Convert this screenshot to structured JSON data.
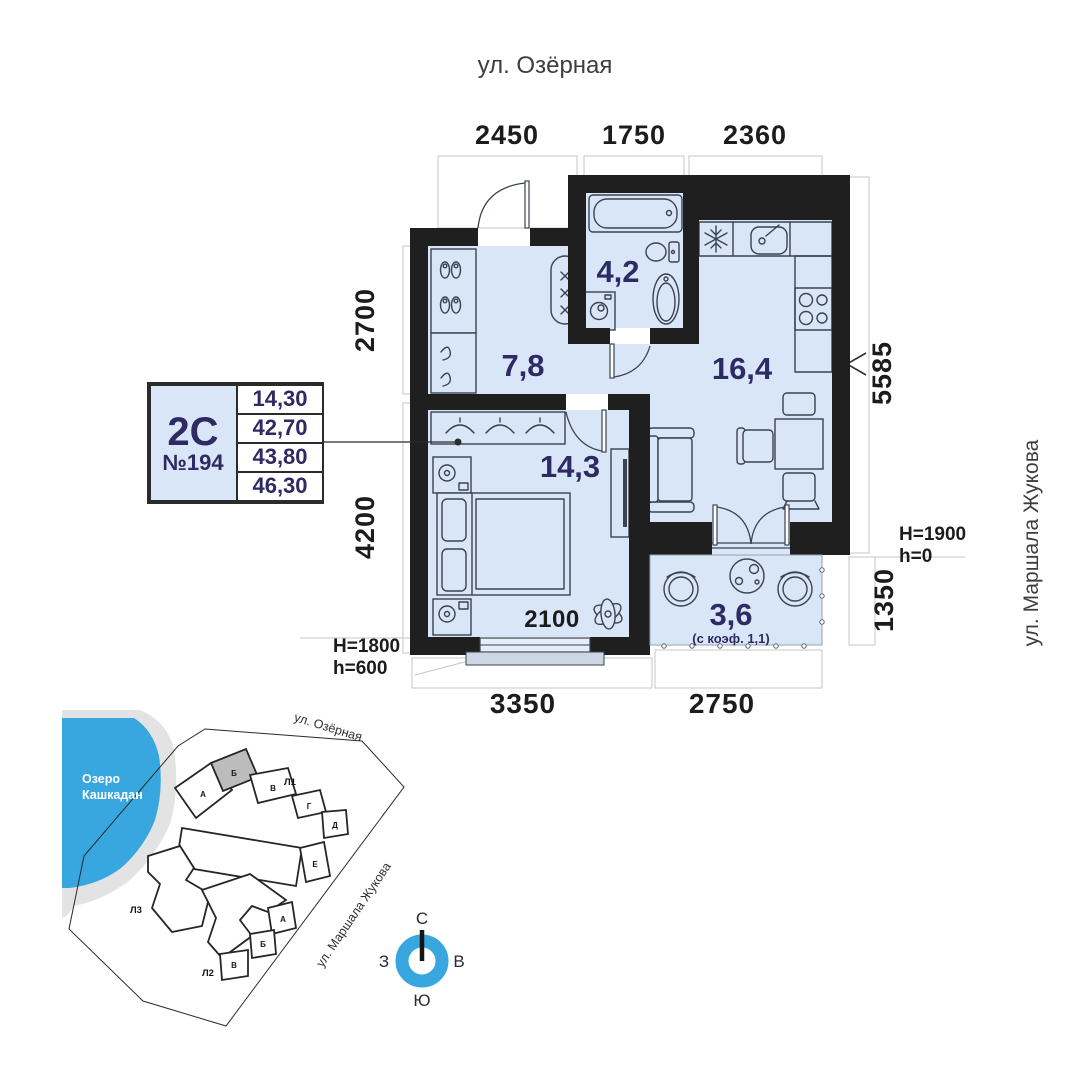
{
  "streets": {
    "top": "ул. Озёрная",
    "right": "ул. Маршала Жукова"
  },
  "plan": {
    "dim_top_1": "2450",
    "dim_top_2": "1750",
    "dim_top_3": "2360",
    "dim_left_upper": "2700",
    "dim_left_lower": "4200",
    "dim_right_upper": "5585",
    "dim_right_lower": "1350",
    "dim_bottom_left": "3350",
    "dim_bottom_right": "2750",
    "dim_window": "2100",
    "label_h_right_1": "H=1900",
    "label_h_right_2": "h=0",
    "label_h_left_1": "H=1800",
    "label_h_left_2": "h=600",
    "areas": {
      "hallway": "7,8",
      "bathroom": "4,2",
      "kitchen_living": "16,4",
      "bedroom": "14,3",
      "balcony": "3,6",
      "balcony_note": "(с коэф. 1,1)"
    }
  },
  "card": {
    "type": "2С",
    "unit": "№194",
    "values": [
      "14,30",
      "42,70",
      "43,80",
      "46,30"
    ]
  },
  "site_map": {
    "lake_name_1": "Озеро",
    "lake_name_2": "Кашкадан",
    "street_top": "ул. Озёрная",
    "street_right": "ул. Маршала Жукова",
    "building_1": "Л1",
    "building_2": "Л2",
    "building_3": "Л3",
    "l1_sections": [
      "А",
      "Б",
      "В",
      "Г",
      "Д",
      "Е"
    ],
    "l2_sections": [
      "А",
      "Б",
      "В"
    ],
    "highlighted_section": "Б"
  },
  "compass": {
    "north": "С",
    "east": "В",
    "south": "Ю",
    "west": "З"
  },
  "colors": {
    "room_fill": "#d9e6f7",
    "wall": "#1f1f1f",
    "navy": "#2e2a63",
    "lake": "#38a7e0",
    "highlight": "#bcbcbc"
  }
}
